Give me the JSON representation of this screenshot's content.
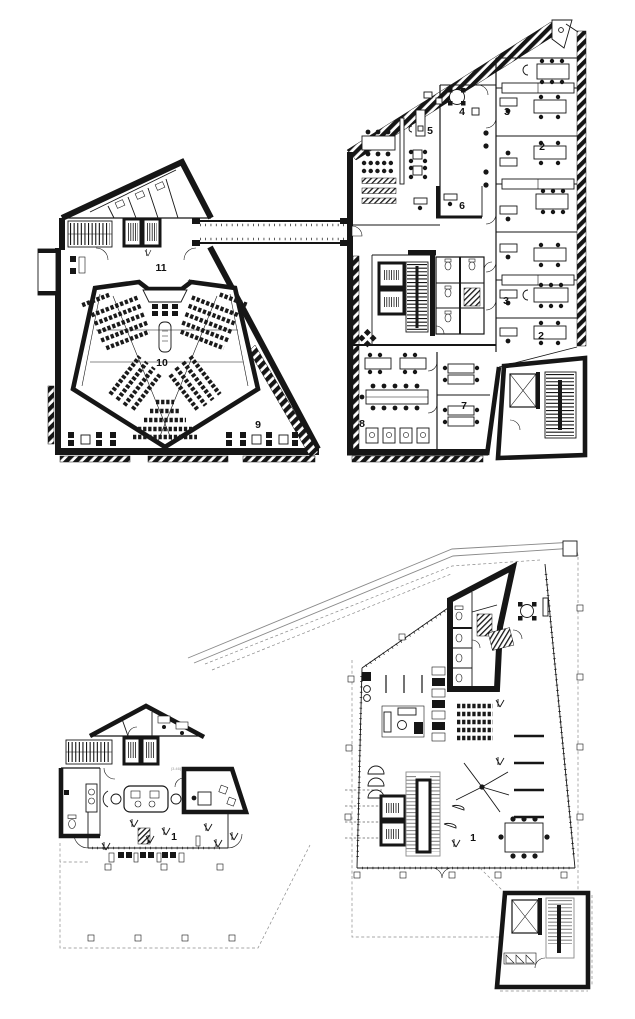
{
  "drawing": {
    "kind": "architectural floor plans, black ink on white",
    "colors": {
      "ink": "#161616",
      "paper": "#ffffff",
      "gray": "#8a8a8a"
    }
  },
  "plans": {
    "upper": {
      "labels": [
        {
          "room": "office-4",
          "text": "4"
        },
        {
          "room": "open-office-5",
          "text": "5"
        },
        {
          "room": "office-3a",
          "text": "3"
        },
        {
          "room": "office-2a",
          "text": "2"
        },
        {
          "room": "room-6",
          "text": "6"
        },
        {
          "room": "office-3b",
          "text": "3"
        },
        {
          "room": "office-2b",
          "text": "2"
        },
        {
          "room": "office-7",
          "text": "7"
        },
        {
          "room": "meeting-8",
          "text": "8"
        },
        {
          "room": "foyer-9",
          "text": "9"
        },
        {
          "room": "auditorium-10",
          "text": "10"
        },
        {
          "room": "lobby-11",
          "text": "11"
        }
      ]
    },
    "ground": {
      "labels": [
        {
          "room": "lobby-1-left",
          "text": "1"
        },
        {
          "room": "hall-1-right",
          "text": "1"
        }
      ],
      "level_note": "(3.46)"
    }
  }
}
